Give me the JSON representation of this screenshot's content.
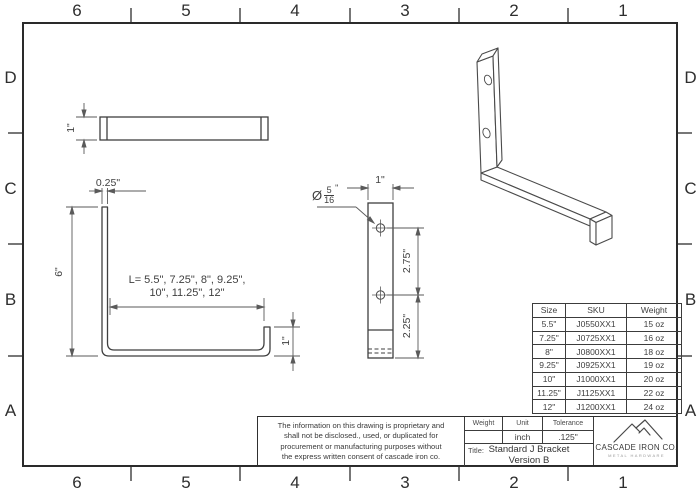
{
  "sheet": {
    "grid_columns": [
      "6",
      "5",
      "4",
      "3",
      "2",
      "1"
    ],
    "grid_rows": [
      "D",
      "C",
      "B",
      "A"
    ]
  },
  "views": {
    "top_view": {
      "width_dim": "1\""
    },
    "side_view": {
      "thickness_dim": "0.25\"",
      "height_dim": "6\"",
      "length_note_line1": "L= 5.5\", 7.25\", 8\", 9.25\",",
      "length_note_line2": "10\", 11.25\", 12\"",
      "lip_dim": "1\""
    },
    "front_view": {
      "width_dim": "1\"",
      "hole_spacing_dim": "2.75\"",
      "hole_bottom_dim": "2.25\"",
      "hole_callout": {
        "prefix": "Ø",
        "numerator": "5",
        "denominator": "16",
        "suffix": "\""
      }
    }
  },
  "size_table": {
    "headers": [
      "Size",
      "SKU",
      "Weight"
    ],
    "rows": [
      [
        "5.5\"",
        "J0550XX1",
        "15 oz"
      ],
      [
        "7.25\"",
        "J0725XX1",
        "16 oz"
      ],
      [
        "8\"",
        "J0800XX1",
        "18 oz"
      ],
      [
        "9.25\"",
        "J0925XX1",
        "19 oz"
      ],
      [
        "10\"",
        "J1000XX1",
        "20 oz"
      ],
      [
        "11.25\"",
        "J1125XX1",
        "22 oz"
      ],
      [
        "12\"",
        "J1200XX1",
        "24 oz"
      ]
    ]
  },
  "title_block": {
    "weight_label": "Weight",
    "unit_label": "Unit",
    "tolerance_label": "Tolerance",
    "weight_value": "",
    "unit_value": "inch",
    "tolerance_value": ".125\"",
    "title_label": "Title:",
    "title_line1": "Standard J Bracket",
    "title_line2": "Version B"
  },
  "proprietary_notice": {
    "lines": [
      "The information on this drawing is proprietary and",
      "shall not be disclosed., used, or duplicated for",
      "procurement or manufacturing purposes without",
      "the express written consent of cascade iron co."
    ]
  },
  "logo": {
    "company": "CASCADE IRON CO.",
    "tagline": "METAL HARDWARE"
  },
  "colors": {
    "line": "#3f3f3f",
    "dimension": "#5a5a5a",
    "background": "#ffffff"
  }
}
